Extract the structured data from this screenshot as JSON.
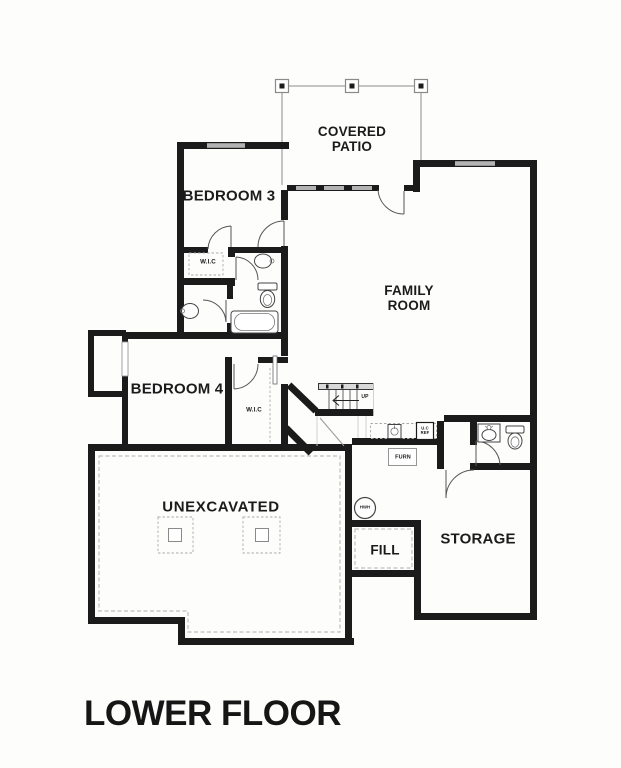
{
  "plan_title": "LOWER FLOOR",
  "rooms": {
    "covered_patio": {
      "line1": "COVERED",
      "line2": "PATIO"
    },
    "bedroom3": {
      "label": "BEDROOM 3"
    },
    "family_room": {
      "line1": "FAMILY",
      "line2": "ROOM"
    },
    "bedroom4": {
      "label": "BEDROOM 4"
    },
    "wic_upper": {
      "label": "W.I.C"
    },
    "wic_lower": {
      "label": "W.I.C"
    },
    "unexcavated": {
      "label": "UNEXCAVATED"
    },
    "fill": {
      "label": "FILL"
    },
    "storage": {
      "label": "STORAGE"
    }
  },
  "annotations": {
    "stairs_direction": "UP",
    "under_counter_fridge_line1": "U.C",
    "under_counter_fridge_line2": "REF",
    "furnace": "FURN",
    "water_heater": "HWH"
  },
  "colors": {
    "wall": "#1b1b1b",
    "patio_outline": "#c4c4c4",
    "window": "#b3b3b3",
    "dashed_line": "#c0c0c0",
    "background": "#ffffff"
  }
}
